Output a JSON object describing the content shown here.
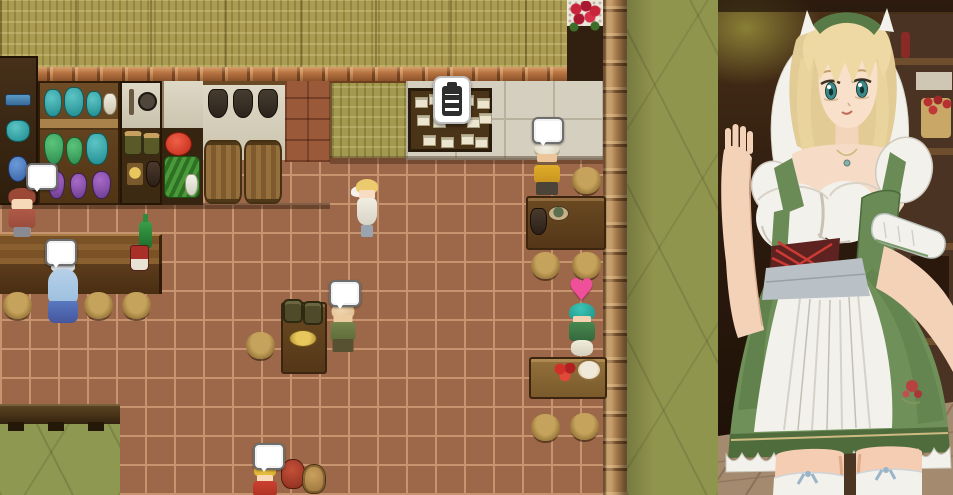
{
  "scene_type": "rpg-tavern-interior-with-waitress-portrait",
  "icons": {
    "heart": "♥",
    "speech_bubble": "rounded-white-balloon",
    "quest_clipboard": "clipboard-with-lines"
  },
  "palette": {
    "floor": "#9d6849",
    "grout": "#c79470",
    "straw": "#ab9c52",
    "wall_green": "#90954e",
    "ledge": "#b5713f",
    "pillar": "#a87c4c",
    "cream": "#d5cfbf",
    "green_floor": "#8f9851",
    "bubble_bg": "#ffffff",
    "heart": "#f0509a",
    "art_skin": "#f6dcc6",
    "art_hair": "#e8d2a0",
    "art_green": "#6a8a56",
    "art_white": "#f3f1ec"
  },
  "scene": {
    "characters": [
      {
        "name": "patron-red-hair",
        "type": "red",
        "x": 5,
        "y": 188,
        "bubble": {
          "x": 26,
          "y": 163
        }
      },
      {
        "name": "patron-blue-robe",
        "type": "blue",
        "x": 46,
        "y": 258,
        "bubble": {
          "x": 45,
          "y": 239
        }
      },
      {
        "name": "waitress-sprite",
        "type": "maid",
        "x": 352,
        "y": 177
      },
      {
        "name": "patron-bald",
        "type": "bald",
        "x": 327,
        "y": 301,
        "bubble": {
          "x": 329,
          "y": 280
        }
      },
      {
        "name": "patron-turban",
        "type": "turban",
        "x": 531,
        "y": 141,
        "bubble": {
          "x": 532,
          "y": 117
        }
      },
      {
        "name": "patron-teal-hair",
        "type": "teal",
        "x": 566,
        "y": 303,
        "heart": {
          "x": 568,
          "y": 278
        }
      },
      {
        "name": "patron-blonde",
        "type": "blonde2",
        "x": 252,
        "y": 463,
        "bubble": {
          "x": 253,
          "y": 443
        }
      }
    ],
    "stools": [
      [
        3,
        292
      ],
      [
        84,
        292
      ],
      [
        122,
        292
      ],
      [
        246,
        332
      ],
      [
        572,
        167
      ],
      [
        531,
        252
      ],
      [
        572,
        252
      ],
      [
        531,
        414
      ],
      [
        570,
        413
      ]
    ],
    "bulletin_notes": [
      [
        4,
        6
      ],
      [
        18,
        3
      ],
      [
        34,
        8
      ],
      [
        50,
        4
      ],
      [
        66,
        7
      ],
      [
        6,
        24
      ],
      [
        22,
        26
      ],
      [
        40,
        22
      ],
      [
        56,
        26
      ],
      [
        68,
        22
      ],
      [
        12,
        44
      ],
      [
        30,
        46
      ],
      [
        50,
        43
      ],
      [
        64,
        46
      ]
    ]
  }
}
